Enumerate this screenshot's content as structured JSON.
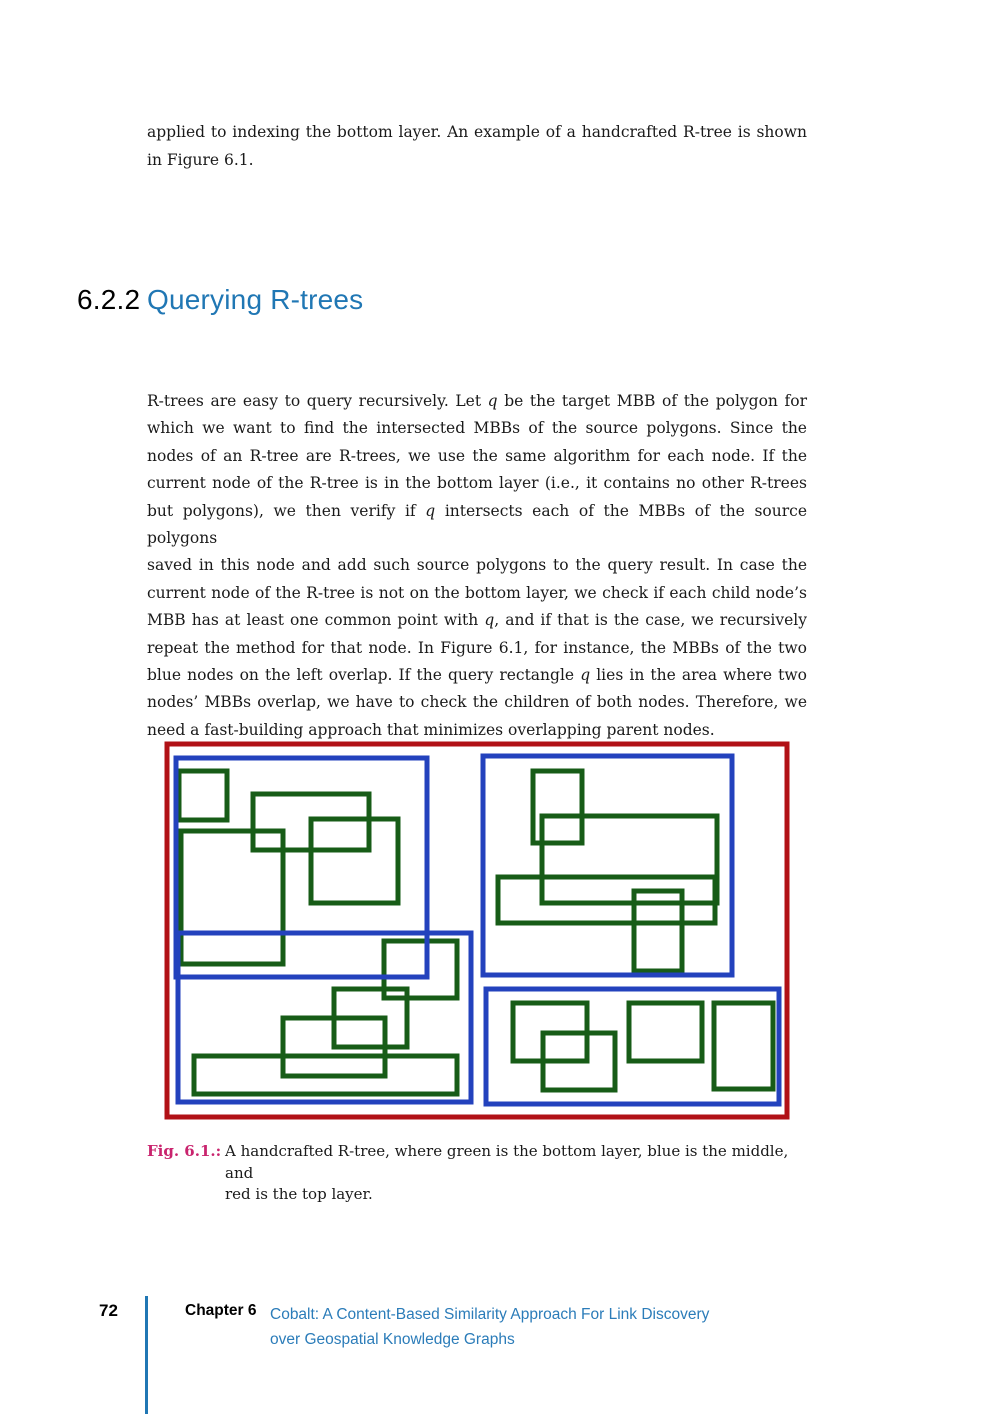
{
  "intro": {
    "lines": [
      "applied to indexing the bottom layer. An example of a handcrafted R-tree is shown",
      "in Figure 6.1."
    ]
  },
  "heading": {
    "number": "6.2.2",
    "title": "Querying R-trees",
    "title_color": "#2077b4"
  },
  "body": {
    "lines": [
      "R-trees are easy to query recursively.  Let {q} be the target MBB of the polygon for",
      "which we want to find the intersected MBBs of the source polygons.  Since the",
      "nodes of an R-tree are R-trees, we use the same algorithm for each node.  If the",
      "current node of the R-tree is in the bottom layer (i.e., it contains no other R-trees",
      "but polygons), we then verify if {q} intersects each of the MBBs of the source polygons",
      "saved in this node and add such source polygons to the query result.  In case the",
      "current node of the R-tree is not on the bottom layer, we check if each child node’s",
      "MBB has at least one common point with {q}, and if that is the case, we recursively",
      "repeat the method for that node.  In Figure 6.1, for instance, the MBBs of the two",
      "blue nodes on the left overlap.  If the query rectangle {q} lies in the area where two",
      "nodes’ MBBs overlap, we have to check the children of both nodes.  Therefore, we",
      "need a fast-building approach that minimizes overlapping parent nodes."
    ]
  },
  "figure": {
    "stroke_width": 5,
    "colors": {
      "green": "#175c17",
      "blue": "#2342bd",
      "red": "#b11116"
    },
    "layers": [
      {
        "name": "bottom-layer-green",
        "color": "green",
        "rects": [
          [
            179,
            771,
            48,
            49
          ],
          [
            253,
            794,
            116,
            56
          ],
          [
            311,
            819,
            87,
            84
          ],
          [
            181,
            831,
            102,
            133
          ],
          [
            533,
            771,
            49,
            72
          ],
          [
            542,
            816,
            175,
            87
          ],
          [
            498,
            877,
            217,
            46
          ],
          [
            634,
            891,
            48,
            80
          ],
          [
            384,
            941,
            73,
            57
          ],
          [
            334,
            989,
            73,
            58
          ],
          [
            283,
            1018,
            102,
            58
          ],
          [
            194,
            1056,
            263,
            38
          ],
          [
            513,
            1003,
            74,
            58
          ],
          [
            543,
            1033,
            72,
            57
          ],
          [
            629,
            1003,
            73,
            58
          ],
          [
            714,
            1003,
            59,
            86
          ]
        ]
      },
      {
        "name": "middle-layer-blue",
        "color": "blue",
        "rects": [
          [
            176,
            758,
            251,
            219
          ],
          [
            483,
            756,
            249,
            219
          ],
          [
            178,
            933,
            293,
            169
          ],
          [
            486,
            989,
            293,
            115
          ]
        ]
      },
      {
        "name": "top-layer-red",
        "color": "red",
        "rects": [
          [
            167,
            744,
            620,
            373
          ]
        ]
      }
    ]
  },
  "caption": {
    "label": "Fig. 6.1.:",
    "label_color": "#c9246e",
    "lines": [
      "A handcrafted R-tree, where green is the bottom layer, blue is the middle, and",
      "red is the top layer."
    ]
  },
  "footer": {
    "page_number": "72",
    "chapter_label": "Chapter 6",
    "accent_color": "#2077b4",
    "chapter_title_lines": [
      "Cobalt: A Content-Based Similarity Approach For Link Discovery",
      "over Geospatial Knowledge Graphs"
    ]
  }
}
